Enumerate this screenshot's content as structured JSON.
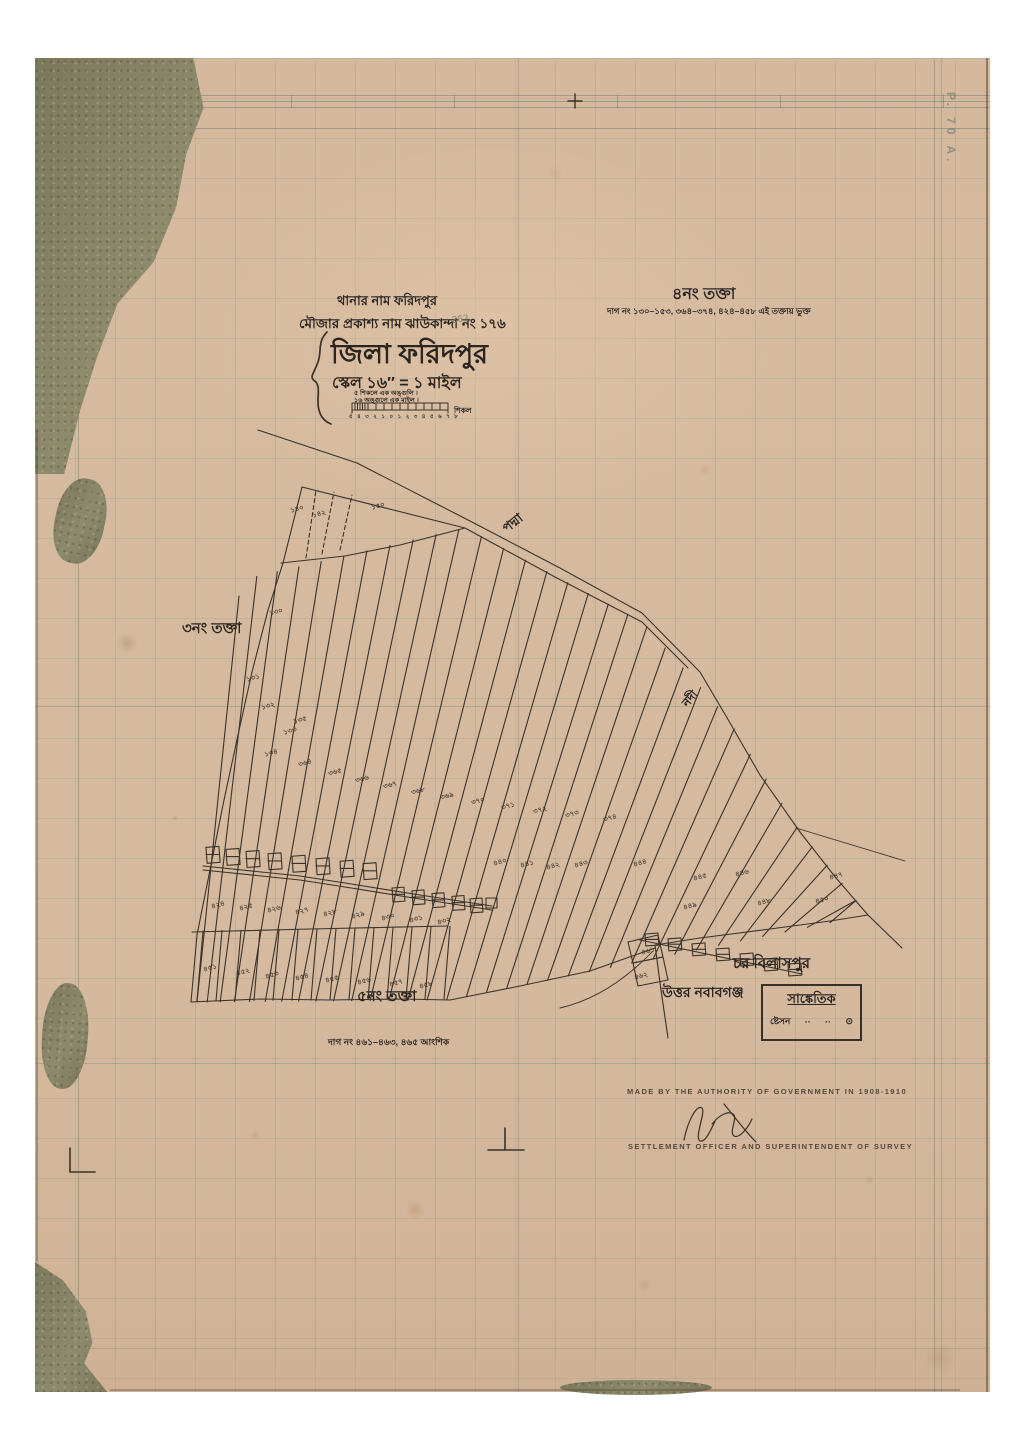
{
  "title_block": {
    "line1": "থানার নাম ফরিদপুর",
    "line2": "মৌজার প্রকাশ্য নাম ঝাউকান্দা নং ১৭৬",
    "district": "জিলা ফরিদপুর",
    "scale": "স্কেল ১৬″ = ১ মাইল",
    "scale_note1": "৫ শিকলে এক অঙ্গুলি ।",
    "scale_note2": "১৬ অঙ্গুলে এক মাইল ।",
    "scale_bar_ticks": "৫ ৪ ৩ ২ ১ ০ ১ ২ ৩ ৪ ৫ ৬ ৭ ৮",
    "scale_bar_unit": "শিকল",
    "pencil_note": "363"
  },
  "sheet4": {
    "title": "৪নং তক্তা",
    "subtitle": "দাগ নং ১৩০–১৫৩, ৩৬৪–৩৭৪, ৪২৪–৪৫৮ এই তক্তায় ভুক্ত"
  },
  "sheet3": {
    "title": "৩নং তক্তা"
  },
  "sheet5": {
    "title": "৫নং তক্তা",
    "subtitle": "দাগ নং ৪৬১–৪৬৩, ৪৬৫ আংশিক"
  },
  "places": {
    "river_padma": "পদ্মা",
    "river_nodi": "নদী",
    "char_bilaspur": "চর বিলাসপুর",
    "uttar_nawabganj": "উত্তর নবাবগঞ্জ"
  },
  "legend": {
    "title": "সাঙ্কেতিক",
    "row_label": "ষ্টেসন",
    "dot1": "··",
    "dot2": "··",
    "symbol": "⊙"
  },
  "footer": {
    "line1": "MADE BY THE AUTHORITY OF GOVERNMENT IN 1908-1910",
    "signature": "J C Jack",
    "line2": "SETTLEMENT OFFICER AND SUPERINTENDENT OF SURVEY"
  },
  "corner_stamp": "P. 70 A.",
  "plot_numbers": [
    {
      "x": 297,
      "y": 509,
      "t": "১৪০"
    },
    {
      "x": 319,
      "y": 514,
      "t": "১৪২"
    },
    {
      "x": 378,
      "y": 506,
      "t": "১৫০"
    },
    {
      "x": 276,
      "y": 612,
      "t": "১৩০"
    },
    {
      "x": 253,
      "y": 678,
      "t": "১৩১"
    },
    {
      "x": 268,
      "y": 706,
      "t": "১৩২"
    },
    {
      "x": 290,
      "y": 731,
      "t": "১৩৩"
    },
    {
      "x": 271,
      "y": 753,
      "t": "১৩৪"
    },
    {
      "x": 300,
      "y": 720,
      "t": "১৩৫"
    },
    {
      "x": 305,
      "y": 763,
      "t": "৩৬৪"
    },
    {
      "x": 335,
      "y": 772,
      "t": "৩৬৫"
    },
    {
      "x": 362,
      "y": 779,
      "t": "৩৬৬"
    },
    {
      "x": 390,
      "y": 785,
      "t": "৩৬৭"
    },
    {
      "x": 418,
      "y": 791,
      "t": "৩৬৮"
    },
    {
      "x": 447,
      "y": 796,
      "t": "৩৬৯"
    },
    {
      "x": 478,
      "y": 801,
      "t": "৩৭০"
    },
    {
      "x": 508,
      "y": 806,
      "t": "৩৭১"
    },
    {
      "x": 540,
      "y": 810,
      "t": "৩৭২"
    },
    {
      "x": 572,
      "y": 814,
      "t": "৩৭৩"
    },
    {
      "x": 610,
      "y": 818,
      "t": "৩৭৪"
    },
    {
      "x": 500,
      "y": 862,
      "t": "৪৪০"
    },
    {
      "x": 527,
      "y": 864,
      "t": "৪৪১"
    },
    {
      "x": 553,
      "y": 866,
      "t": "৪৪২"
    },
    {
      "x": 581,
      "y": 864,
      "t": "৪৪৩"
    },
    {
      "x": 640,
      "y": 863,
      "t": "৪৪৪"
    },
    {
      "x": 700,
      "y": 877,
      "t": "৪৪৫"
    },
    {
      "x": 742,
      "y": 873,
      "t": "৪৪৬"
    },
    {
      "x": 836,
      "y": 876,
      "t": "৪৪৭"
    },
    {
      "x": 764,
      "y": 902,
      "t": "৪৪৮"
    },
    {
      "x": 690,
      "y": 906,
      "t": "৪৪৯"
    },
    {
      "x": 822,
      "y": 900,
      "t": "৪৫০"
    },
    {
      "x": 218,
      "y": 905,
      "t": "৪২৪"
    },
    {
      "x": 246,
      "y": 907,
      "t": "৪২৫"
    },
    {
      "x": 274,
      "y": 909,
      "t": "৪২৬"
    },
    {
      "x": 302,
      "y": 911,
      "t": "৪২৭"
    },
    {
      "x": 330,
      "y": 913,
      "t": "৪২৮"
    },
    {
      "x": 358,
      "y": 915,
      "t": "৪২৯"
    },
    {
      "x": 388,
      "y": 917,
      "t": "৪৩০"
    },
    {
      "x": 416,
      "y": 919,
      "t": "৪৩১"
    },
    {
      "x": 444,
      "y": 921,
      "t": "৪৩২"
    },
    {
      "x": 210,
      "y": 968,
      "t": "৪৫১"
    },
    {
      "x": 243,
      "y": 972,
      "t": "৪৫২"
    },
    {
      "x": 272,
      "y": 975,
      "t": "৪৫৩"
    },
    {
      "x": 302,
      "y": 977,
      "t": "৪৫৪"
    },
    {
      "x": 332,
      "y": 979,
      "t": "৪৫৫"
    },
    {
      "x": 364,
      "y": 981,
      "t": "৪৫৬"
    },
    {
      "x": 396,
      "y": 983,
      "t": "৪৫৭"
    },
    {
      "x": 426,
      "y": 985,
      "t": "৪৫৮"
    },
    {
      "x": 648,
      "y": 951,
      "t": "৪৬১"
    },
    {
      "x": 641,
      "y": 976,
      "t": "৪৬২"
    }
  ]
}
